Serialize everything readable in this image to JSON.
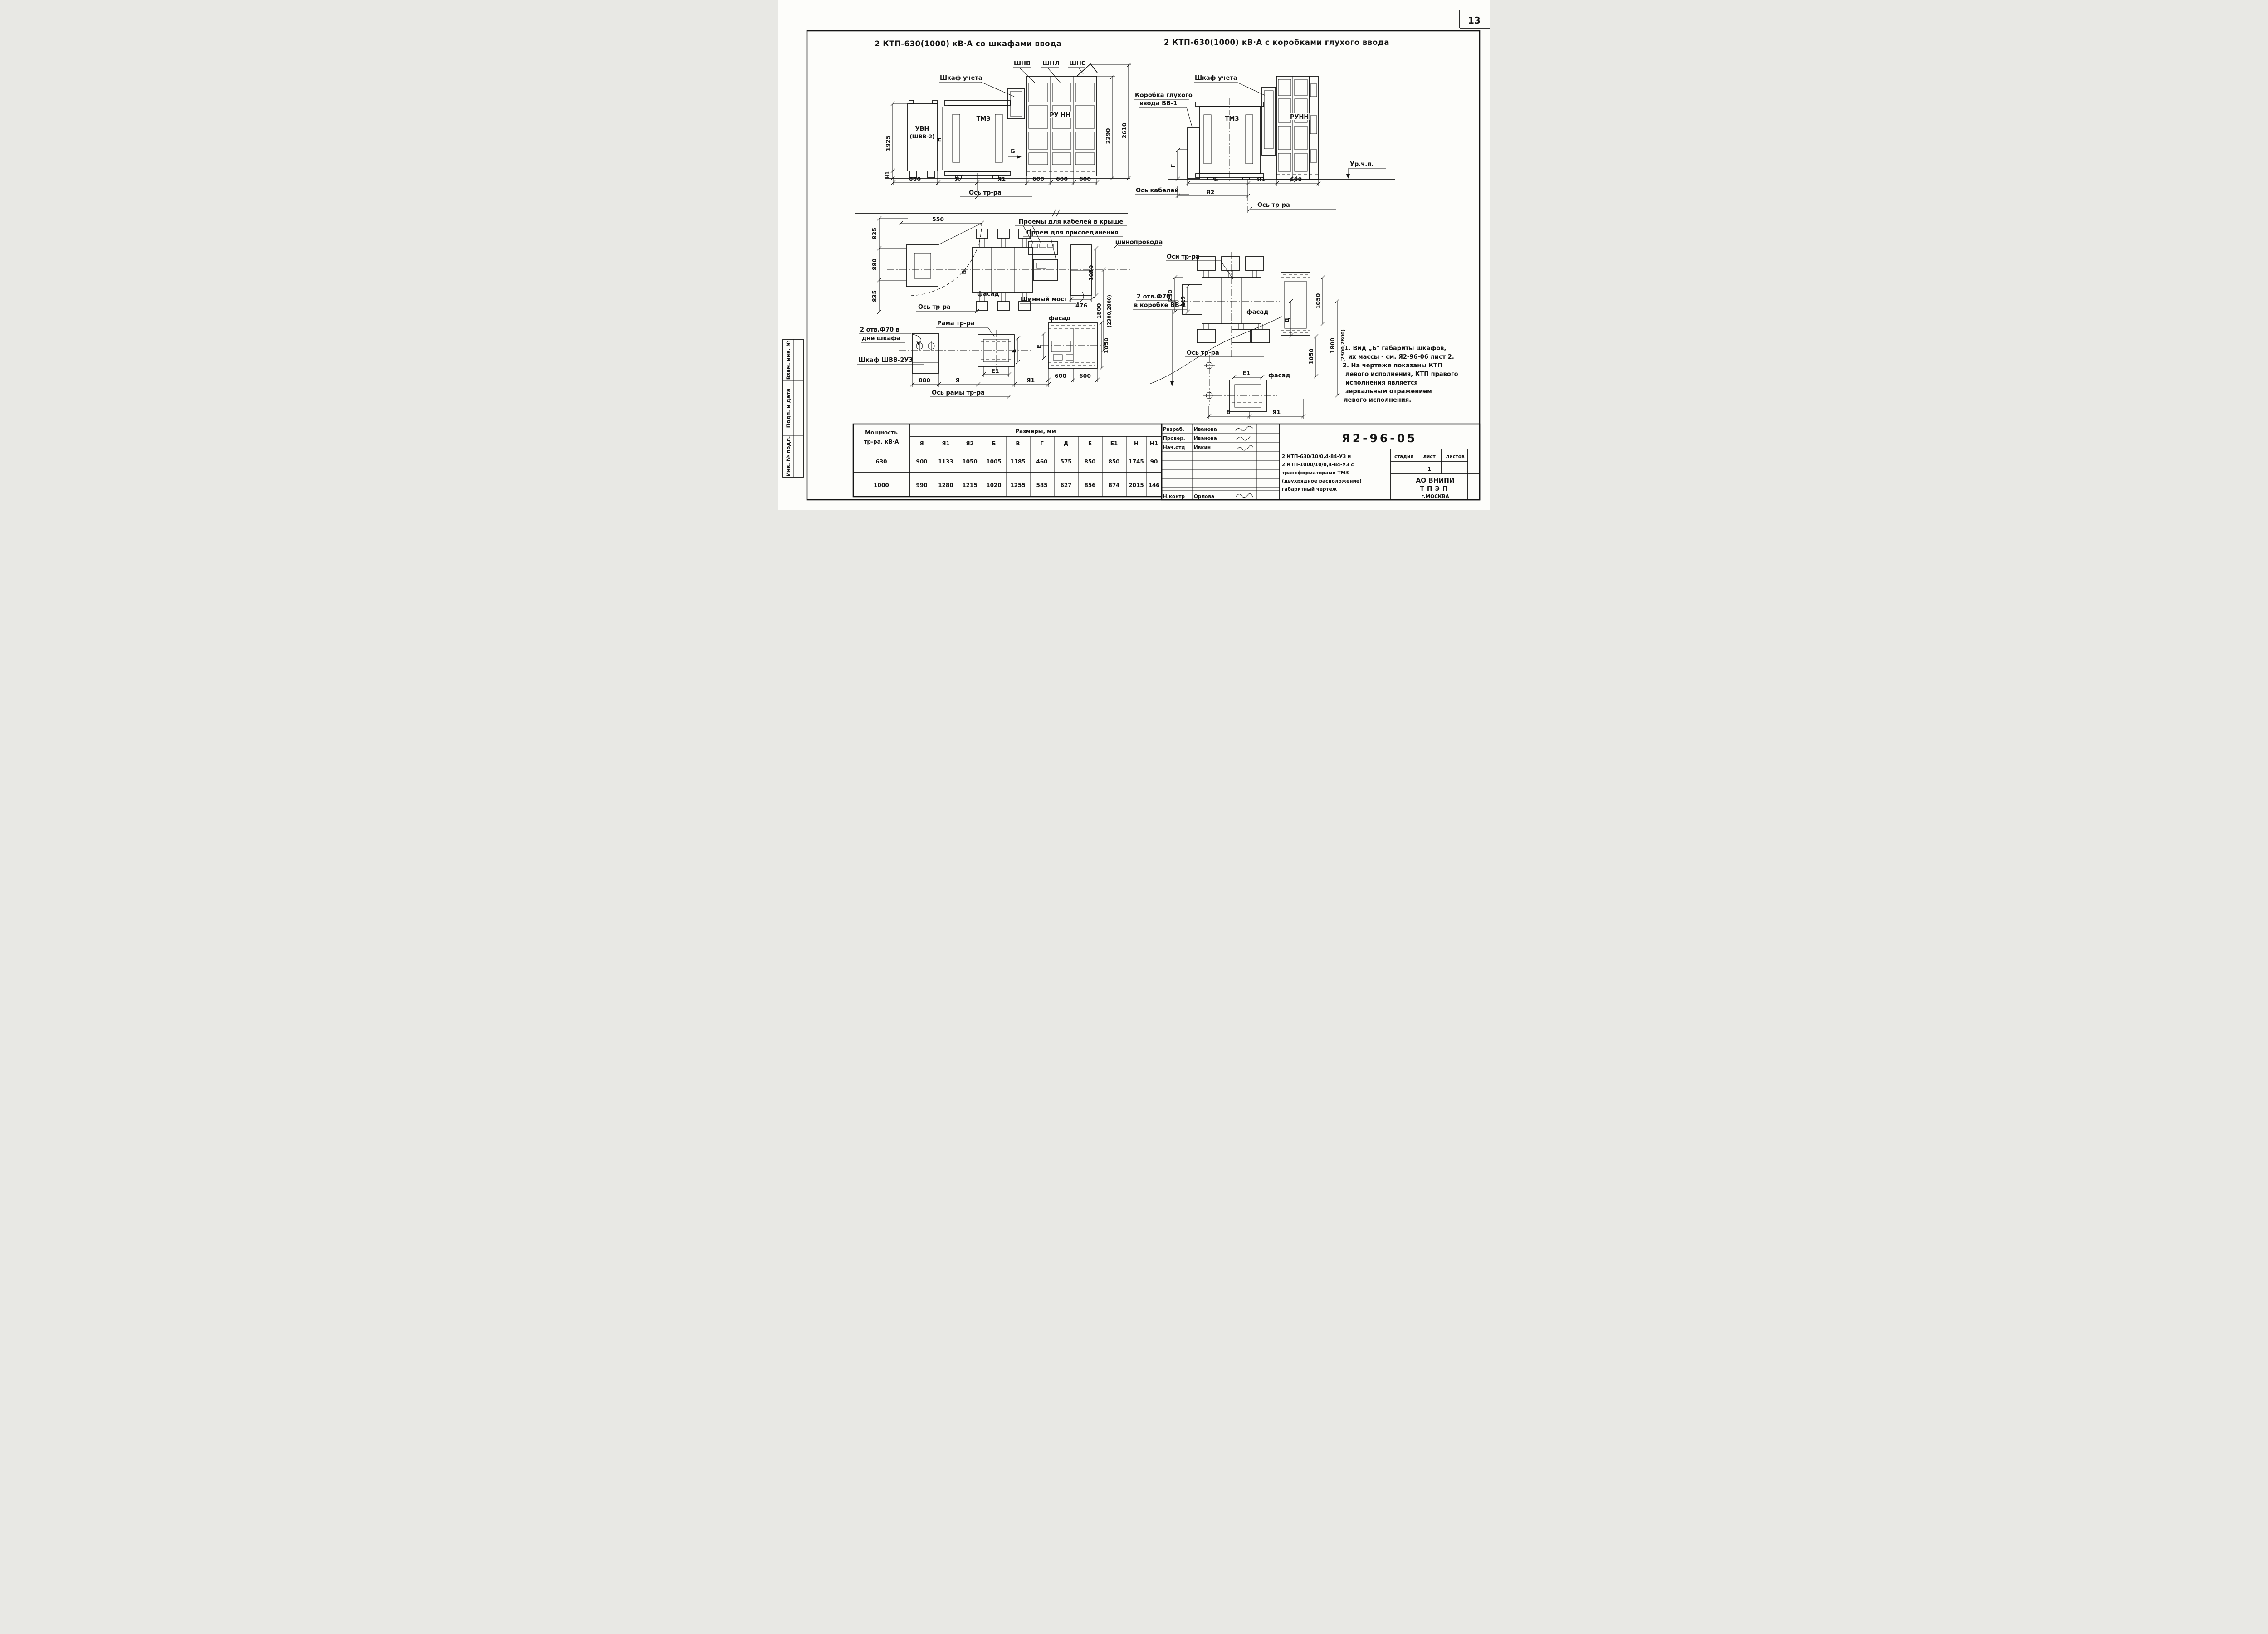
{
  "page": {
    "number": "13"
  },
  "titles": {
    "left": "2 КТП-630(1000) кВ·А со шкафами ввода",
    "right": "2 КТП-630(1000) кВ·А с коробками глухого ввода"
  },
  "stamp": {
    "f1": "Взам. инв. №",
    "f2": "Подп. и дата",
    "f3": "Инв. № подл."
  },
  "elev_left": {
    "shnv": "ШНВ",
    "shnl": "ШНЛ",
    "shns": "ШНС",
    "shkaf_ucheta": "Шкаф учета",
    "uvn1": "УВН",
    "uvn2": "(ШВВ-2)",
    "tmz": "ТМЗ",
    "runn": "РУ НН",
    "b": "Б",
    "h": "Н",
    "h1": "Н1",
    "d1925": "1925",
    "d2290": "2290",
    "d2610": "2610",
    "d880": "880",
    "dya": "Я",
    "dya1": "Я1",
    "d600a": "600",
    "d600b": "600",
    "d600c": "600",
    "os": "Ось тр-ра"
  },
  "elev_right": {
    "korobka1": "Коробка глухого",
    "korobka2": "ввода ВВ-1",
    "shkaf_ucheta": "Шкаф учета",
    "tmz": "ТМЗ",
    "runn": "РУНН",
    "urchp": "Ур.ч.п.",
    "g": "Г",
    "db": "Б",
    "dya1": "Я1",
    "d600": "600",
    "dya2": "Я2",
    "os_kab": "Ось кабелей",
    "os": "Ось тр-ра"
  },
  "plan_left": {
    "d550": "550",
    "d835a": "835",
    "d880": "880",
    "d835b": "835",
    "pro1": "Проемы для кабелей в крыше",
    "pro2": "Проем для присоединения",
    "pro3": "шинопровода",
    "fasad": "фасад",
    "shin": "Шинный мост",
    "d476": "476",
    "d1050": "1050",
    "d1800": "1800",
    "d1800b": "(2300,2800)",
    "v": "В",
    "os": "Ось тр-ра"
  },
  "det_left": {
    "otv1": "2 отв.Ф70 в",
    "otv2": "дне шкафа",
    "shkaf": "Шкаф ШВВ-2УЗ",
    "rama": "Рама тр-ра",
    "d880": "880",
    "dya": "Я",
    "de1": "Е1",
    "dya1": "Я1",
    "de": "Е",
    "os": "Ось рамы тр-ра"
  },
  "panel": {
    "fasad": "фасад",
    "d600a": "600",
    "d600b": "600",
    "d1050": "1050",
    "de": "Е"
  },
  "plan_right": {
    "osi": "Оси тр-ра",
    "d230": "230",
    "d115": "115",
    "fasad": "фасад",
    "otv1": "2 отв.Ф70",
    "otv2": "в коробке ВВ-1",
    "os": "Ось тр-ра",
    "dd": "Д",
    "d1050a": "1050",
    "d1050b": "1050",
    "d1800": "1800",
    "d1800b": "(2300,2800)"
  },
  "det_right": {
    "de1": "Е1",
    "fasad": "фасад",
    "db": "Б",
    "dya1": "Я1"
  },
  "notes": {
    "l1": "1. Вид „Б\" габариты шкафов,",
    "l2": "их массы - см. Я2-96-06 лист 2.",
    "l3": "2. На чертеже показаны КТП",
    "l4": "левого исполнения, КТП правого",
    "l5": "исполнения является",
    "l6": "зеркальным отражением",
    "l7": "левого исполнения."
  },
  "table": {
    "h1": "Мощность",
    "h2": "тр-ра, кВ·А",
    "sizes": "Размеры, мм",
    "cols": [
      "Я",
      "Я1",
      "Я2",
      "Б",
      "В",
      "Г",
      "Д",
      "Е",
      "Е1",
      "Н",
      "Н1"
    ],
    "rows": [
      {
        "power": "630",
        "values": [
          "900",
          "1133",
          "1050",
          "1005",
          "1185",
          "460",
          "575",
          "850",
          "850",
          "1745",
          "90"
        ]
      },
      {
        "power": "1000",
        "values": [
          "990",
          "1280",
          "1215",
          "1020",
          "1255",
          "585",
          "627",
          "856",
          "874",
          "2015",
          "146"
        ]
      }
    ]
  },
  "tb": {
    "doc": "Я2-96-05",
    "r1role": "Разраб.",
    "r1name": "Иванова",
    "r2role": "Провер.",
    "r2name": "Иванова",
    "r3role": "Нач.отд",
    "r3name": "Ивкин",
    "r4role": "Н.контр",
    "r4name": "Орлова",
    "desc1": "2 КТП-630/10/0,4-84-У3 и",
    "desc2": "2 КТП-1000/10/0,4-84-У3 с",
    "desc3": "трансформаторами ТМЗ",
    "desc4": "(двухрядное расположение)",
    "desc5": "габаритный чертеж",
    "stage": "стадия",
    "sheet": "лист",
    "sheets": "листов",
    "sheet_val": "1",
    "org1": "АО ВНИПИ",
    "org2": "ТПЭП",
    "org3": "г.МОСКВА"
  }
}
